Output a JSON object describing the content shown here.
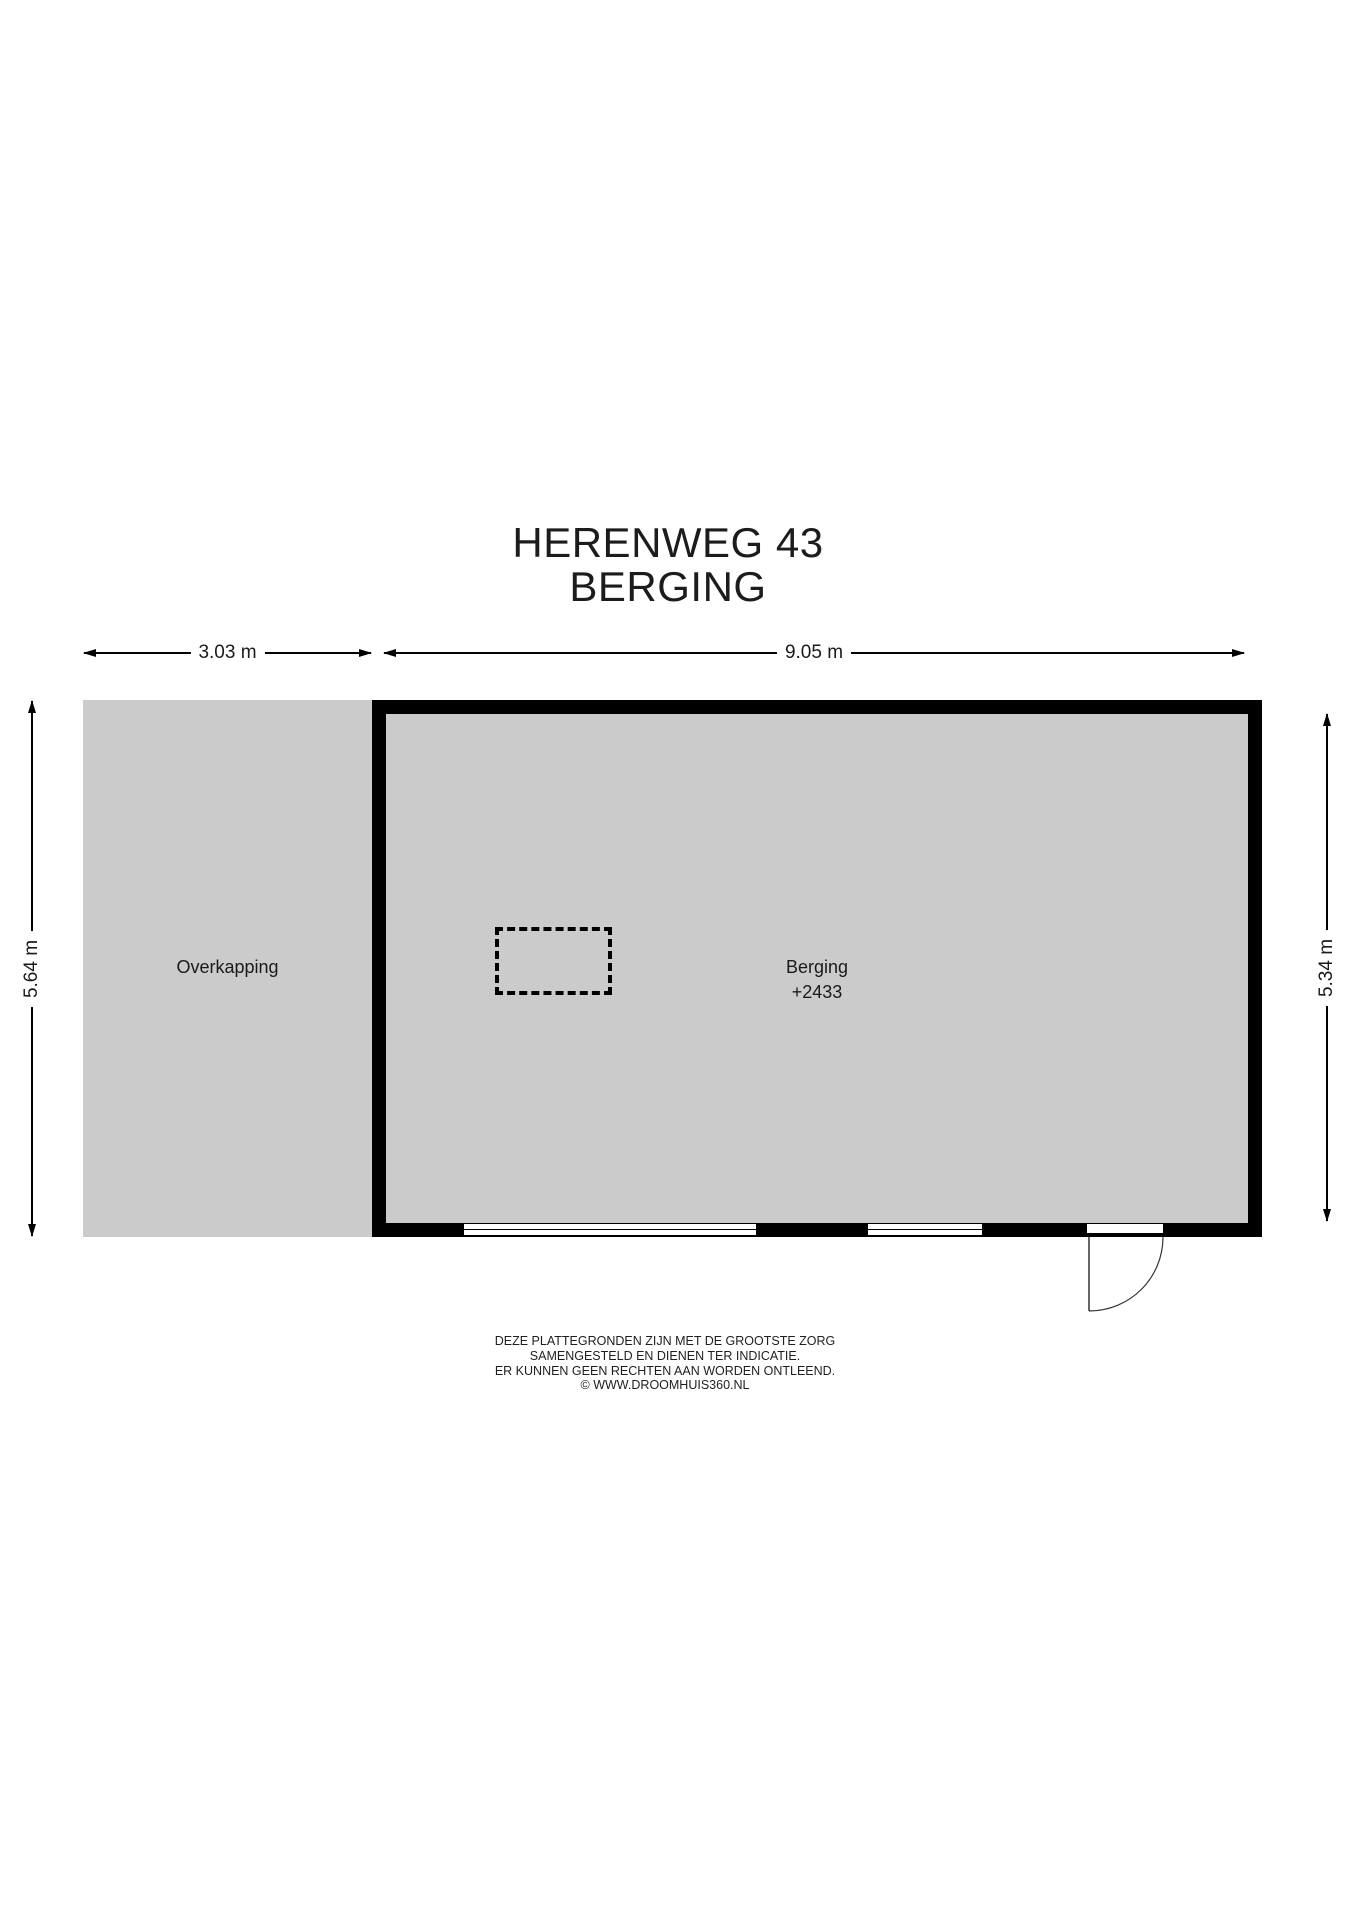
{
  "title": {
    "line1": "HERENWEG 43",
    "line2": "BERGING"
  },
  "dimensions": {
    "overkapping_width": "3.03 m",
    "berging_width": "9.05 m",
    "left_height": "5.64 m",
    "right_height": "5.34 m"
  },
  "rooms": {
    "overkapping": {
      "label": "Overkapping"
    },
    "berging": {
      "label": "Berging",
      "elevation": "+2433"
    }
  },
  "disclaimer": {
    "lines": [
      "DEZE PLATTEGRONDEN ZIJN MET DE GROOTSTE ZORG",
      "SAMENGESTELD EN DIENEN TER INDICATIE.",
      "ER KUNNEN GEEN RECHTEN AAN WORDEN ONTLEEND.",
      "© WWW.DROOMHUIS360.NL"
    ]
  },
  "colors": {
    "floor_fill": "#cbcbcb",
    "wall": "#000000",
    "background": "#ffffff",
    "text": "#1a1a1a"
  }
}
